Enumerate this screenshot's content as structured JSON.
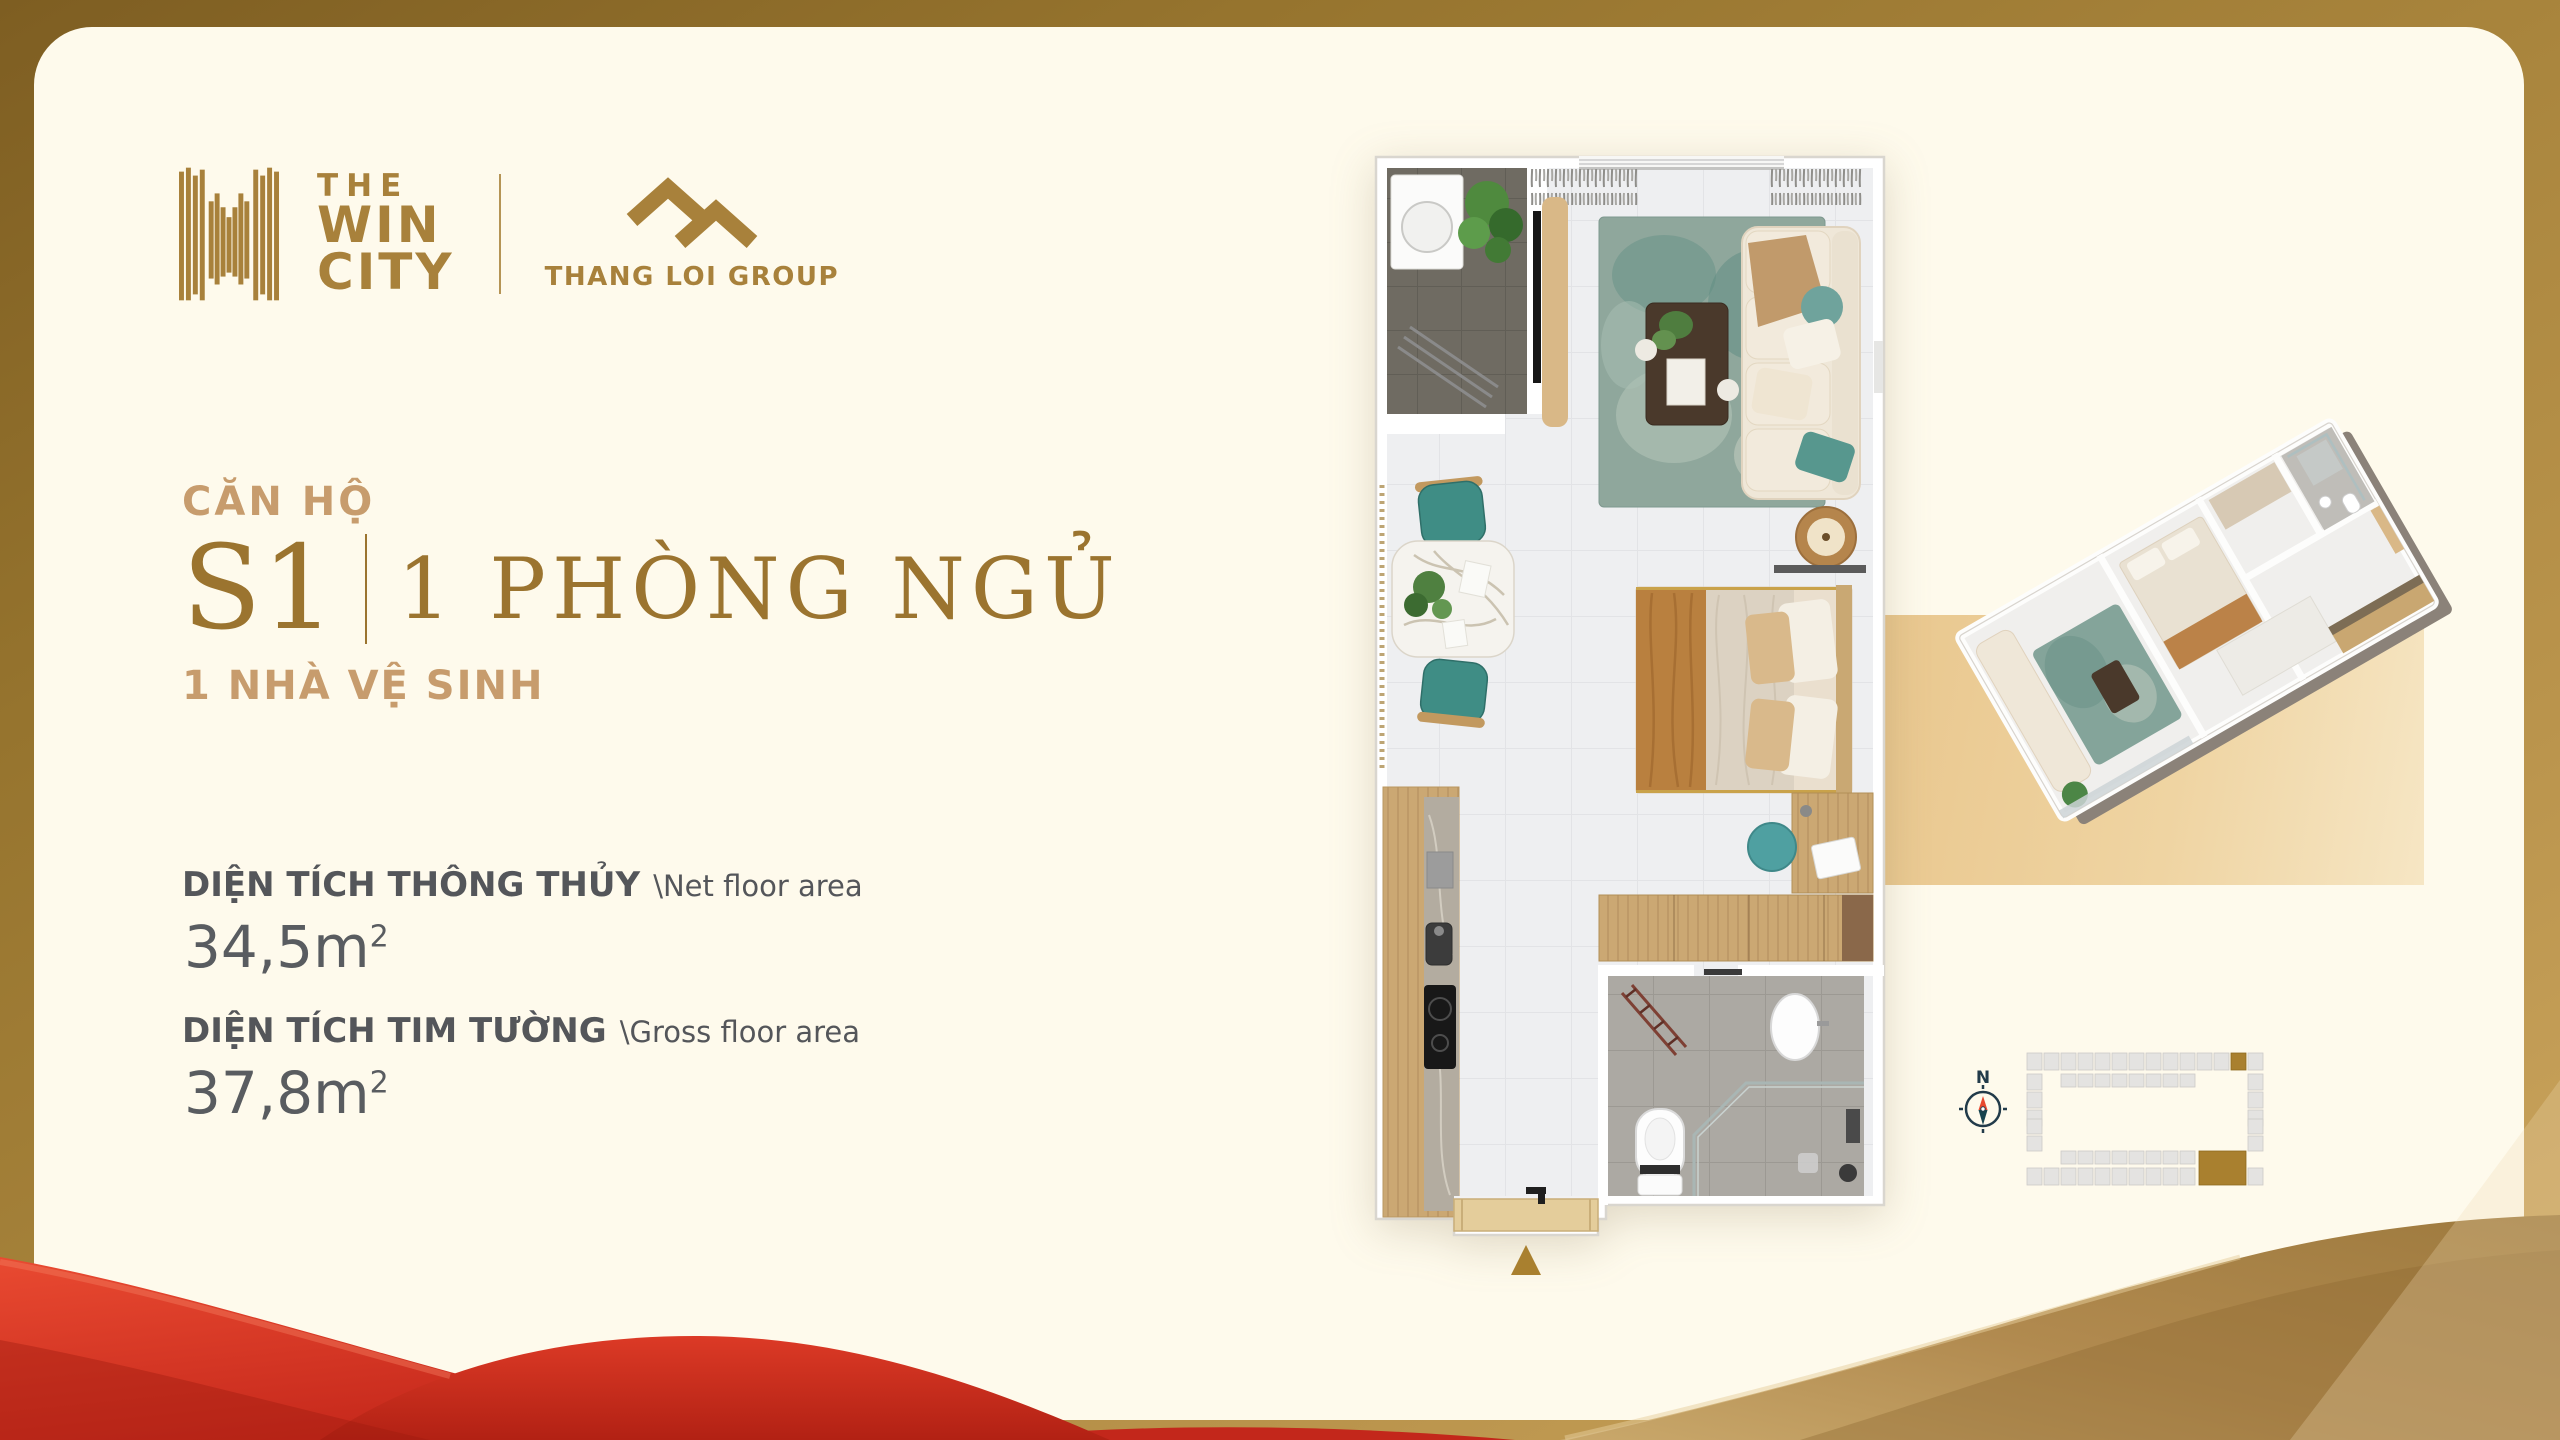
{
  "brand": {
    "win_city": {
      "lines": [
        "THE",
        "WIN",
        "CITY"
      ]
    },
    "thang_loi": {
      "name": "THANG LOI GROUP"
    }
  },
  "unit": {
    "label": "CĂN HỘ",
    "code": "S1",
    "bedrooms": "1 PHÒNG NGỦ",
    "bathrooms": "1 NHÀ VỆ SINH"
  },
  "areas": {
    "net": {
      "label_vi": "DIỆN TÍCH THÔNG THỦY",
      "label_en": "\\Net floor area",
      "value": "34,5m",
      "sup": "2"
    },
    "gross": {
      "label_vi": "DIỆN TÍCH TIM TƯỜNG",
      "label_en": "\\Gross floor area",
      "value": "37,8m",
      "sup": "2"
    }
  },
  "site_plan": {
    "compass_label": "N",
    "highlighted_unit_color": "#a9802f"
  },
  "icons": [
    "win-city-logo-icon",
    "thang-loi-logo-icon",
    "compass-icon",
    "entrance-arrow-icon"
  ],
  "colors": {
    "card_background": "#fefaec",
    "brand_gold": "#a8813b",
    "heading_tan": "#c79c6d",
    "serif_gold": "#9b742f",
    "text_gray": "#54565a",
    "highlight_gold": "#a9802f",
    "red_wave": "#d62f1f",
    "gold_wave": "#a07a3e"
  }
}
